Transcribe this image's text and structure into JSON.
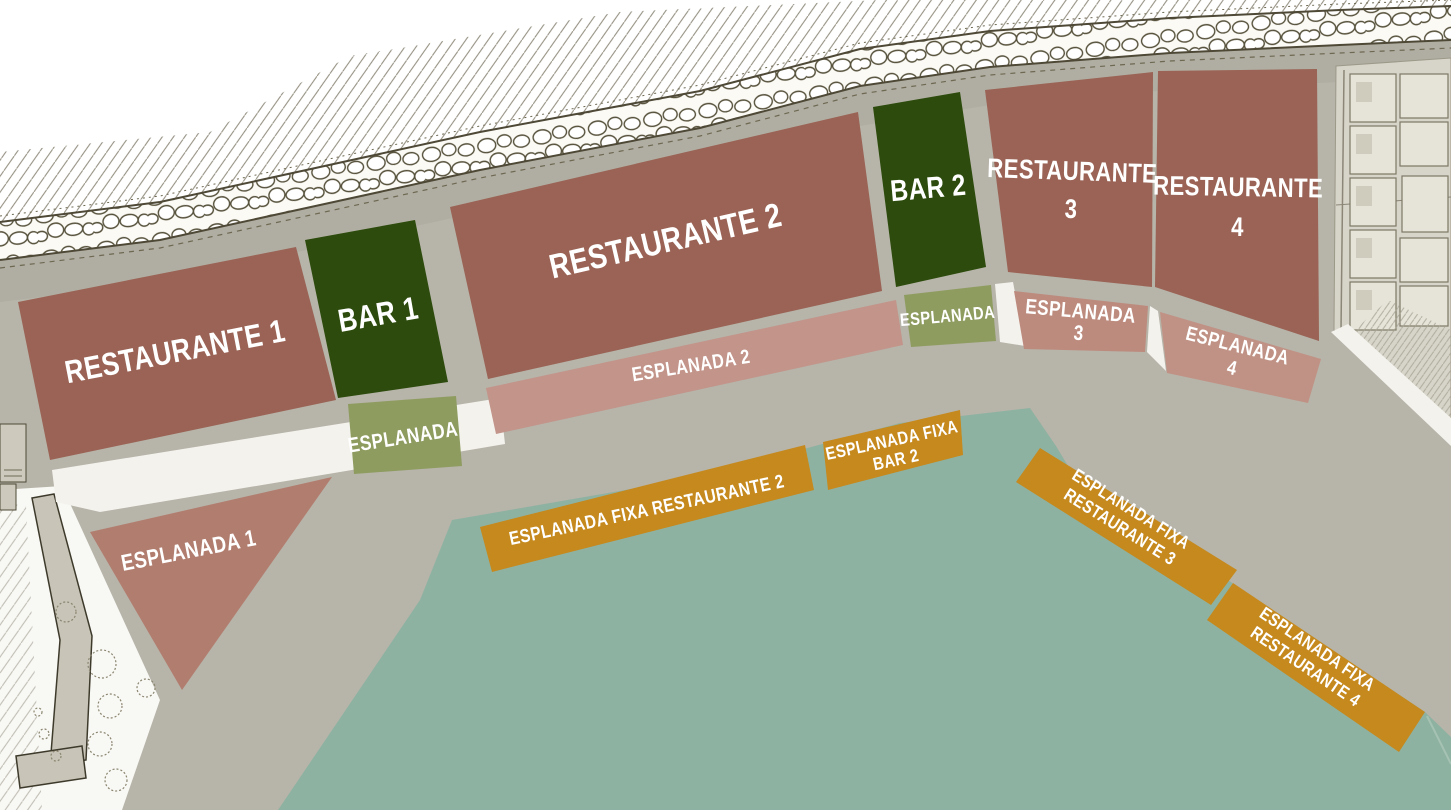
{
  "colors": {
    "restaurant": "#9a6355",
    "bar": "#2c4b0c",
    "esplanada_olive": "#8e9c60",
    "esplanada_1": "#b17d6f",
    "esplanada_2": "#c2948a",
    "esplanada_3": "#bd8b7e",
    "esplanada_4": "#c09285",
    "esplanada_fixa": "#c5891d",
    "water": "#8eb2a2",
    "promenade": "#b7b4a9",
    "walkway": "#f3f2ed"
  },
  "zones": {
    "restaurante_1": {
      "label": "RESTAURANTE 1"
    },
    "bar_1": {
      "label": "BAR 1"
    },
    "esplanada_bar_1": {
      "label": "ESPLANADA"
    },
    "restaurante_2": {
      "label": "RESTAURANTE 2"
    },
    "esplanada_2": {
      "label": "ESPLANADA 2"
    },
    "bar_2": {
      "label": "BAR 2"
    },
    "esplanada_bar_2": {
      "label": "ESPLANADA"
    },
    "restaurante_3": {
      "line1": "RESTAURANTE",
      "line2": "3"
    },
    "restaurante_4": {
      "line1": "RESTAURANTE",
      "line2": "4"
    },
    "esplanada_3": {
      "line1": "ESPLANADA",
      "line2": "3"
    },
    "esplanada_4": {
      "line1": "ESPLANADA",
      "line2": "4"
    },
    "esplanada_1": {
      "label": "ESPLANADA 1"
    },
    "esplanada_fixa_restaurante_2": {
      "label": "ESPLANADA FIXA RESTAURANTE 2"
    },
    "esplanada_fixa_bar_2": {
      "line1": "ESPLANADA FIXA",
      "line2": "BAR 2"
    },
    "esplanada_fixa_restaurante_3": {
      "line1": "ESPLANADA FIXA",
      "line2": "RESTAURANTE 3"
    },
    "esplanada_fixa_restaurante_4": {
      "line1": "ESPLANADA FIXA",
      "line2": "RESTAURANTE 4"
    }
  }
}
